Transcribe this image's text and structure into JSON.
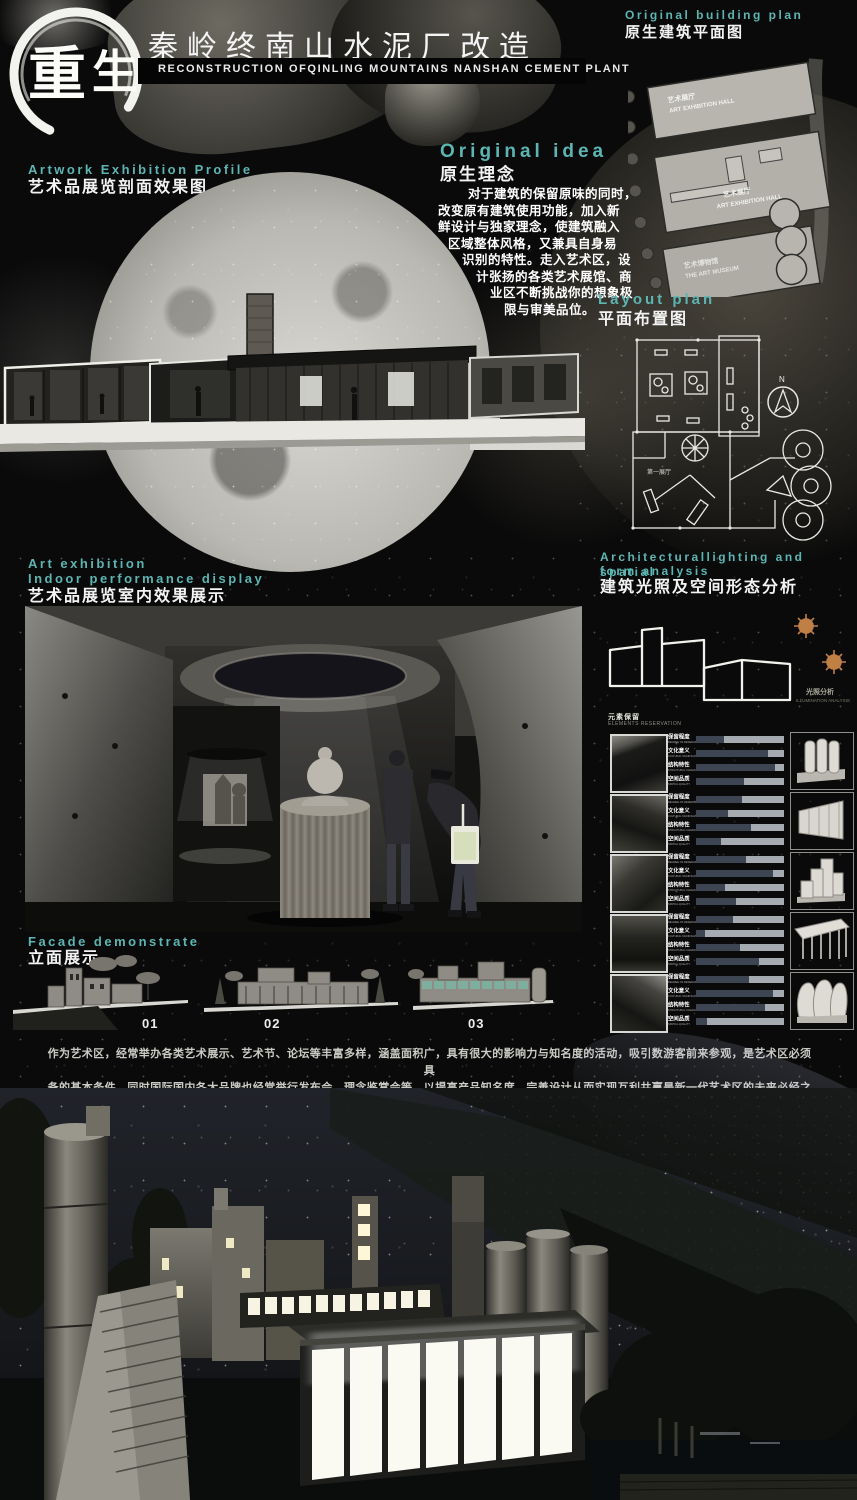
{
  "colors": {
    "accent": "#5cb5b2",
    "background": "#0a0a0a",
    "bar_dark": "#3d4452",
    "bar_light": "#a6abb1",
    "sun": "#c08045"
  },
  "header": {
    "logo_text": "重生",
    "title_cn": "秦岭终南山水泥厂改造",
    "title_en": "RECONSTRUCTION OFQINLING MOUNTAINS NANSHAN CEMENT PLANT"
  },
  "original_building_plan": {
    "heading_en": "Original building plan",
    "heading_cn": "原生建筑平面图",
    "labels": {
      "hall1_cn": "艺术展厅",
      "hall1_en": "ART EXHIBITION HALL",
      "hall2_cn": "艺术展厅",
      "hall2_en": "ART EXHIBITION HALL",
      "museum_cn": "艺术博物馆",
      "museum_en": "THE ART MUSEUM"
    }
  },
  "artwork_profile": {
    "heading_en": "Artwork Exhibition Profile",
    "heading_cn": "艺术品展览剖面效果图"
  },
  "original_idea": {
    "heading_en": "Original idea",
    "heading_cn": "原生理念",
    "paragraph_lines": [
      "对于建筑的保留原味的同时，",
      "改变原有建筑使用功能，加入新",
      "鲜设计与独家理念，使建筑融入",
      "区域整体风格，又兼具自身易",
      "识别的特性。走入艺术区，设",
      "计张扬的各类艺术展馆、商",
      "业区不断挑战你的想象极",
      "限与审美品位。"
    ]
  },
  "layout_plan": {
    "heading_en": "Layout plan",
    "heading_cn": "平面布置图",
    "north_label": "N",
    "room_label": "第一展厅"
  },
  "art_exhibition": {
    "heading_en_line1": "Art exhibition",
    "heading_en_line2": "Indoor performance display",
    "heading_cn": "艺术品展览室内效果展示"
  },
  "lighting_analysis": {
    "heading_en_line1": "Architecturallighting and spatial",
    "heading_en_line2": "form analysis",
    "heading_cn": "建筑光照及空间形态分析",
    "diagram_caption_cn": "光照分析",
    "diagram_caption_en": "ILLUMINATION ANALYSIS"
  },
  "analysis_table": {
    "header_cn": "元素保留",
    "header_en": "ELEMENTS RESERVATION",
    "bar_labels": [
      {
        "cn": "保留程度",
        "en": "DEGREE OF RESERVATION"
      },
      {
        "cn": "文化意义",
        "en": "CULTURAL SIGNIFICANCE"
      },
      {
        "cn": "结构特性",
        "en": "STRUCTURAL CHARACTER"
      },
      {
        "cn": "空间品质",
        "en": "SPATIAL QUALITY"
      }
    ],
    "rows": [
      {
        "bars": [
          0.32,
          0.82,
          0.9,
          0.55
        ]
      },
      {
        "bars": [
          0.52,
          0.36,
          0.62,
          0.28
        ]
      },
      {
        "bars": [
          0.57,
          0.88,
          0.33,
          0.45
        ]
      },
      {
        "bars": [
          0.42,
          0.1,
          0.5,
          0.72
        ]
      },
      {
        "bars": [
          0.6,
          0.88,
          0.78,
          0.12
        ]
      }
    ],
    "forms": [
      "silo-cluster",
      "tapered-hall",
      "stepped-hall",
      "canopy-structure",
      "round-silos"
    ]
  },
  "facade": {
    "heading_en": "Facade demonstrate",
    "heading_cn": "立面展示",
    "numbers": [
      "01",
      "02",
      "03"
    ]
  },
  "footer_paragraph": {
    "line1": "作为艺术区，经常举办各类艺术展示、艺术节、论坛等丰富多样，涵盖面积广，具有很大的影响力与知名度的活动，吸引数游客前来参观，是艺术区必须具",
    "line2": "备的基本条件。同时国际国内各大品牌也经常举行发布会、理念鉴赏会等，以提高产品知名度，完善设计从而实现互利共赢是新一代艺术区的未来必经之路。"
  }
}
